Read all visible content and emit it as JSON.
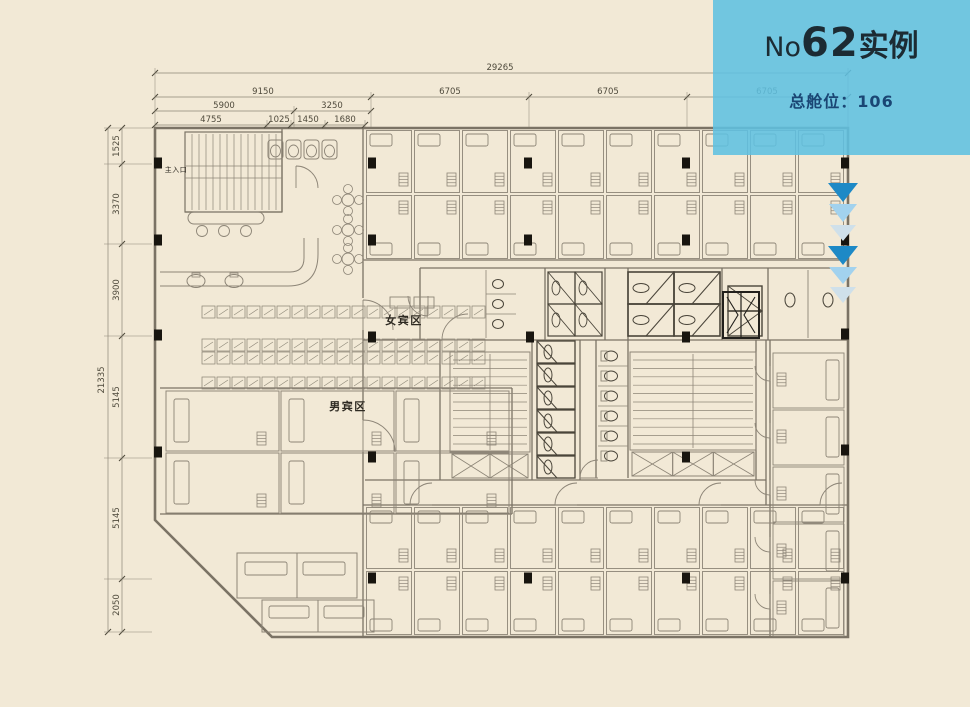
{
  "banner": {
    "prefix": "No",
    "number": "62",
    "suffix": "实例",
    "capacity_label": "总舱位：",
    "capacity_value": "106",
    "background": "#5fc0e1",
    "title_color": "#1c2b33",
    "capacity_color": "#1a4674"
  },
  "plan": {
    "labels": {
      "main_entrance": "主入口",
      "female_area": "女宾区",
      "male_area": "男宾区"
    },
    "dimensions": {
      "total_width": "29265",
      "top_tier2": [
        "9150",
        "6705",
        "6705",
        "6705"
      ],
      "top_tier3": [
        "5900",
        "3250"
      ],
      "top_tier4": [
        "4755",
        "1025",
        "1450",
        "1680"
      ],
      "total_height": "21335",
      "left_segments": [
        "1525",
        "3370",
        "3900",
        "5145",
        "5145",
        "2050"
      ]
    },
    "colors": {
      "paper": "#f2e9d6",
      "line": "#8d8577",
      "wall": "#7b7365",
      "dark": "#4a453a",
      "column": "#18150f"
    }
  },
  "scroll_arrows": {
    "colors": [
      "#1d89c6",
      "#a2d2ee",
      "#cfe0ea",
      "#1d89c6",
      "#a2d2ee",
      "#cfe0ea"
    ]
  }
}
